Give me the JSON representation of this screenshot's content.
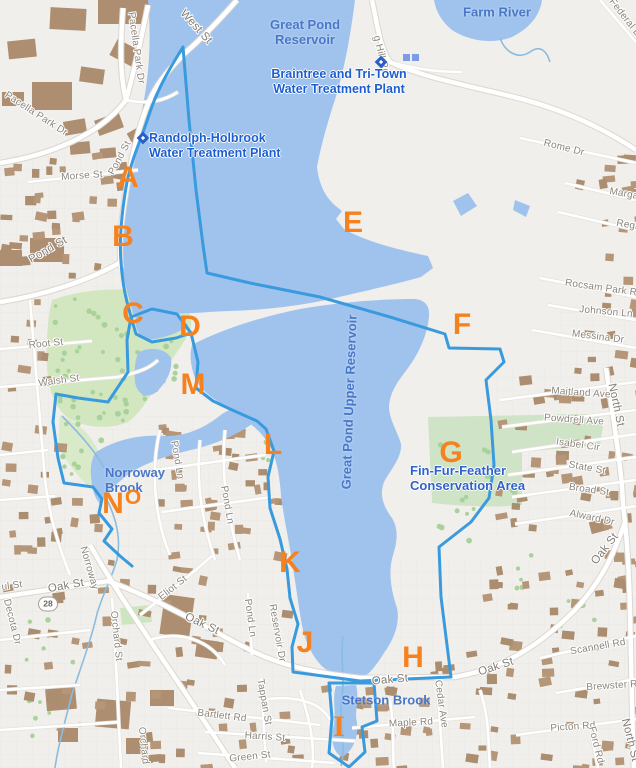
{
  "map": {
    "description": "Street map of Great Pond Reservoir watershed with lettered boundary points",
    "colors": {
      "water": "#a0c3ee",
      "boundary": "#3a9ade",
      "land": "#f1efeb",
      "building": "#b59679",
      "park_green": "#d2e7bf",
      "conservation_green": "#cfe3c6",
      "letter_orange": "#f5821f",
      "water_label_blue": "#4877c8",
      "poi_label_blue": "#1c5ed0"
    },
    "route_shield": {
      "number": "28",
      "x": 48,
      "y": 604
    },
    "boundary_letters": [
      {
        "label": "A",
        "x": 128,
        "y": 178,
        "size": 30
      },
      {
        "label": "B",
        "x": 123,
        "y": 237,
        "size": 30
      },
      {
        "label": "C",
        "x": 133,
        "y": 314,
        "size": 30
      },
      {
        "label": "D",
        "x": 190,
        "y": 327,
        "size": 30
      },
      {
        "label": "E",
        "x": 353,
        "y": 223,
        "size": 30
      },
      {
        "label": "F",
        "x": 462,
        "y": 325,
        "size": 30
      },
      {
        "label": "G",
        "x": 451,
        "y": 453,
        "size": 30
      },
      {
        "label": "H",
        "x": 413,
        "y": 658,
        "size": 30
      },
      {
        "label": "I",
        "x": 339,
        "y": 727,
        "size": 30,
        "serif": true
      },
      {
        "label": "J",
        "x": 305,
        "y": 643,
        "size": 30
      },
      {
        "label": "K",
        "x": 290,
        "y": 563,
        "size": 30
      },
      {
        "label": "L",
        "x": 273,
        "y": 445,
        "size": 30
      },
      {
        "label": "M",
        "x": 193,
        "y": 385,
        "size": 30
      },
      {
        "label": "N",
        "x": 113,
        "y": 504,
        "size": 30
      },
      {
        "label": "O",
        "x": 133,
        "y": 498,
        "size": 21
      }
    ],
    "water_labels": [
      {
        "lines": [
          "Great Pond",
          "Reservoir"
        ],
        "x": 305,
        "y": 32
      },
      {
        "lines": [
          "Farm River"
        ],
        "x": 497,
        "y": 12
      },
      {
        "lines": [
          "Norroway",
          "Brook"
        ],
        "x": 105,
        "y": 480,
        "align": "left"
      },
      {
        "lines": [
          "Stetson Brook"
        ],
        "x": 386,
        "y": 700
      },
      {
        "lines": [
          "Great Pond Upper Reservoir"
        ],
        "x": 349,
        "y": 402,
        "rot": -88
      }
    ],
    "conservation_label": {
      "lines": [
        "Fin-Fur-Feather",
        "Conservation Area"
      ],
      "x": 410,
      "y": 478,
      "align": "left"
    },
    "poi_markers": [
      {
        "name": "braintree-tri-town-water-treatment-plant",
        "lines": [
          "Braintree and Tri-Town",
          "Water Treatment Plant"
        ],
        "marker_x": 381,
        "marker_y": 62,
        "text_x": 339,
        "text_y": 82
      },
      {
        "name": "randolph-holbrook-water-treatment-plant",
        "lines": [
          "Randolph-Holbrook",
          "Water Treatment Plant"
        ],
        "marker_x": 143,
        "marker_y": 138,
        "text_x": 149,
        "text_y": 146,
        "align": "left"
      }
    ],
    "street_labels": [
      {
        "text": "West St",
        "x": 196,
        "y": 27,
        "rot": 48,
        "big": true
      },
      {
        "text": "Pacella Park Dr",
        "x": 136,
        "y": 48,
        "rot": 82
      },
      {
        "text": "Pacella Park Dr",
        "x": 36,
        "y": 114,
        "rot": 33
      },
      {
        "text": "Morse St",
        "x": 82,
        "y": 176,
        "rot": -4
      },
      {
        "text": "Pond St",
        "x": 120,
        "y": 158,
        "rot": -62
      },
      {
        "text": "Pond St",
        "x": 48,
        "y": 250,
        "rot": -30,
        "big": true
      },
      {
        "text": "Root St",
        "x": 46,
        "y": 344,
        "rot": -6
      },
      {
        "text": "Walsh St",
        "x": 59,
        "y": 381,
        "rot": -8
      },
      {
        "text": "g Hill Rd",
        "x": 381,
        "y": 55,
        "rot": 76
      },
      {
        "text": "Federal D",
        "x": 625,
        "y": 18,
        "rot": 52
      },
      {
        "text": "Rome Dr",
        "x": 564,
        "y": 148,
        "rot": 14
      },
      {
        "text": "Marga",
        "x": 624,
        "y": 194,
        "rot": 10
      },
      {
        "text": "Regi",
        "x": 627,
        "y": 225,
        "rot": 10
      },
      {
        "text": "Rocsam Park R",
        "x": 601,
        "y": 288,
        "rot": 8
      },
      {
        "text": "Johnson Ln",
        "x": 606,
        "y": 312,
        "rot": 5
      },
      {
        "text": "Messina Dr",
        "x": 598,
        "y": 337,
        "rot": 7
      },
      {
        "text": "North St",
        "x": 616,
        "y": 405,
        "rot": 78,
        "big": true
      },
      {
        "text": "Maitland Ave",
        "x": 581,
        "y": 393,
        "rot": 4
      },
      {
        "text": "Powdrell Ave",
        "x": 574,
        "y": 420,
        "rot": 4
      },
      {
        "text": "Isabel Cir",
        "x": 578,
        "y": 445,
        "rot": 8
      },
      {
        "text": "State St",
        "x": 587,
        "y": 468,
        "rot": 10
      },
      {
        "text": "Broad St",
        "x": 589,
        "y": 490,
        "rot": 8
      },
      {
        "text": "Alward Dr",
        "x": 592,
        "y": 518,
        "rot": 12
      },
      {
        "text": "Pond Ln",
        "x": 177,
        "y": 460,
        "rot": 80
      },
      {
        "text": "Pond Ln",
        "x": 227,
        "y": 505,
        "rot": 80
      },
      {
        "text": "ul St",
        "x": 12,
        "y": 586,
        "rot": -8
      },
      {
        "text": "Oak St",
        "x": 66,
        "y": 586,
        "rot": -10,
        "big": true
      },
      {
        "text": "Oak St",
        "x": 202,
        "y": 624,
        "rot": 25,
        "big": true
      },
      {
        "text": "Oak St",
        "x": 390,
        "y": 680,
        "rot": -5,
        "big": true
      },
      {
        "text": "Oak St",
        "x": 496,
        "y": 667,
        "rot": -18,
        "big": true
      },
      {
        "text": "Oak St",
        "x": 605,
        "y": 549,
        "rot": -52,
        "big": true
      },
      {
        "text": "Decota Dr",
        "x": 12,
        "y": 622,
        "rot": 76
      },
      {
        "text": "Norroway",
        "x": 89,
        "y": 568,
        "rot": 74
      },
      {
        "text": "Orchard St",
        "x": 116,
        "y": 636,
        "rot": 84
      },
      {
        "text": "Orchard St",
        "x": 144,
        "y": 752,
        "rot": 84
      },
      {
        "text": "Eliot St",
        "x": 173,
        "y": 588,
        "rot": -38
      },
      {
        "text": "Pond Ln",
        "x": 250,
        "y": 618,
        "rot": 82
      },
      {
        "text": "Reservoir Dr",
        "x": 277,
        "y": 633,
        "rot": 80
      },
      {
        "text": "Tappan St",
        "x": 264,
        "y": 702,
        "rot": 80
      },
      {
        "text": "Bartlett Rd",
        "x": 222,
        "y": 716,
        "rot": 7
      },
      {
        "text": "Harris St",
        "x": 265,
        "y": 737,
        "rot": 4
      },
      {
        "text": "Green St",
        "x": 250,
        "y": 757,
        "rot": -6
      },
      {
        "text": "Maple Rd",
        "x": 411,
        "y": 723,
        "rot": -3
      },
      {
        "text": "Cedar Ave",
        "x": 441,
        "y": 704,
        "rot": 82
      },
      {
        "text": "Scannell Rd",
        "x": 598,
        "y": 647,
        "rot": -10
      },
      {
        "text": "Brewster R",
        "x": 612,
        "y": 686,
        "rot": -4
      },
      {
        "text": "Picton Rd",
        "x": 573,
        "y": 727,
        "rot": -4
      },
      {
        "text": "Ford Rd",
        "x": 596,
        "y": 745,
        "rot": 76
      },
      {
        "text": "North St",
        "x": 630,
        "y": 740,
        "rot": 76,
        "big": true
      }
    ]
  }
}
